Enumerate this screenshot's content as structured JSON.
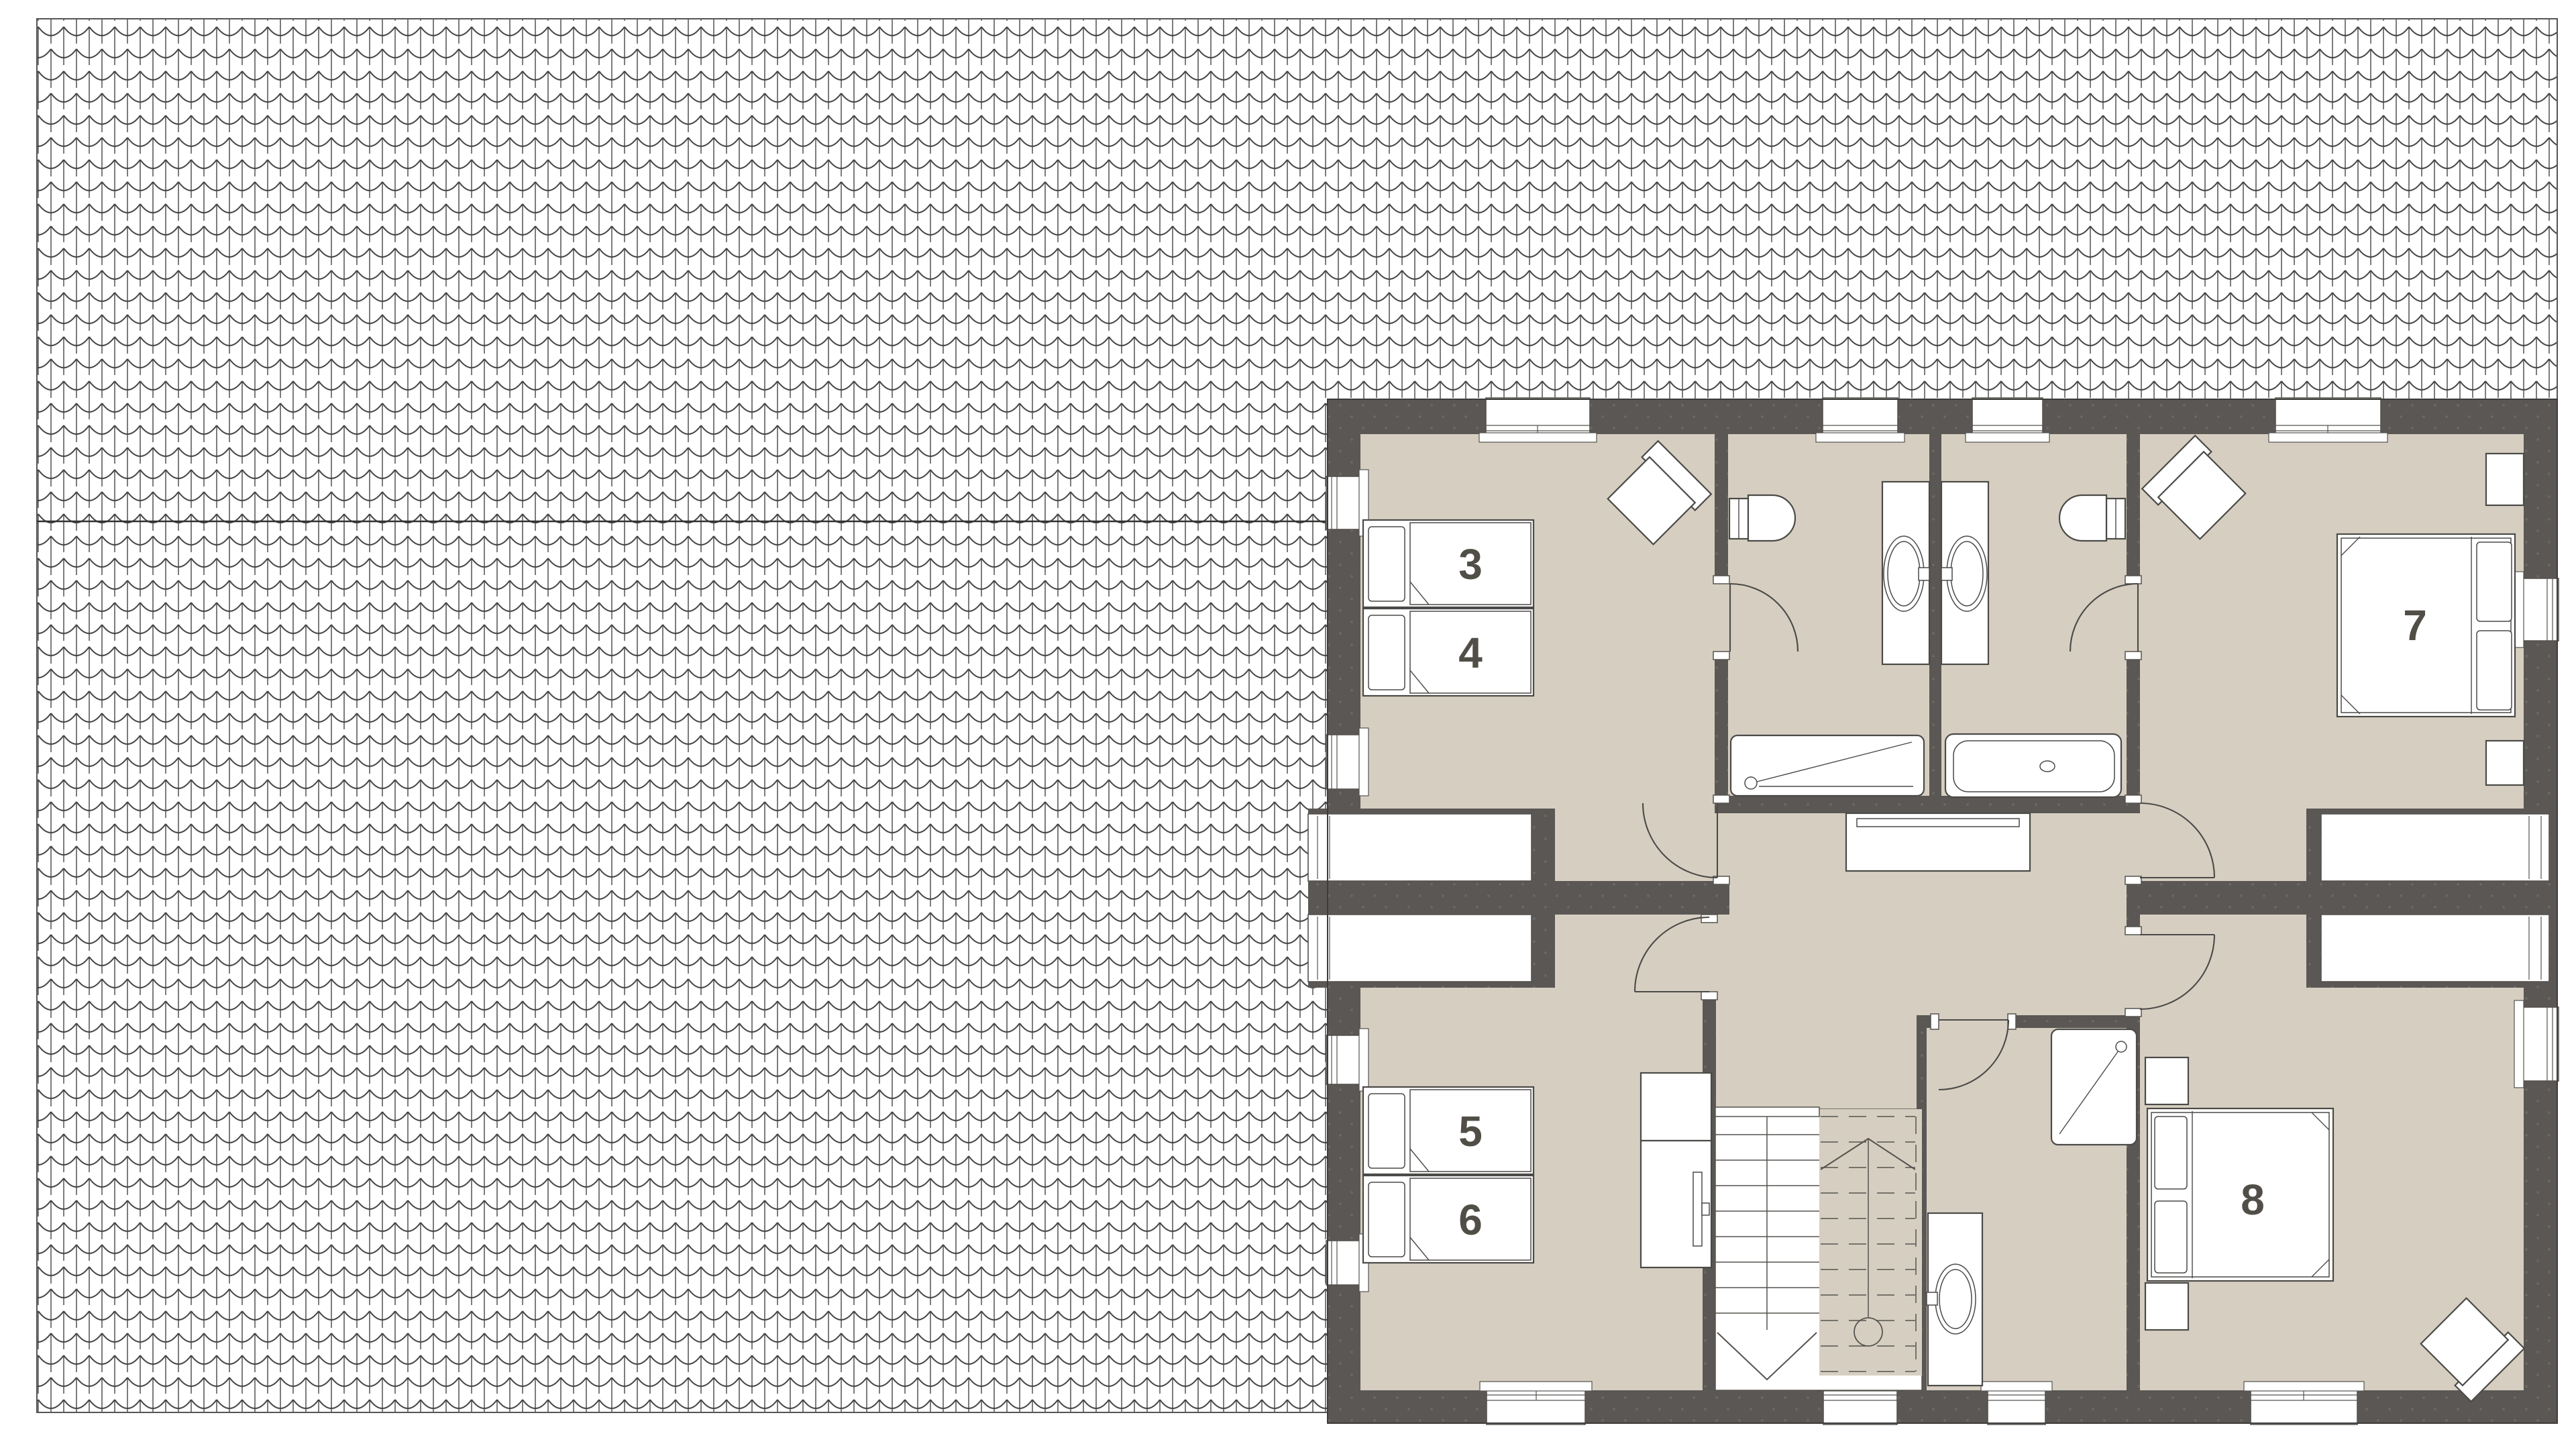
{
  "page": {
    "title": "Upper floor plan with roof",
    "type": "architectural-floor-plan"
  },
  "theme": {
    "floor": "#d6cfc1",
    "wall": "#5a5754",
    "wallDot": "#73716c",
    "line": "#55534f",
    "furnitureLine": "#4b4a48",
    "roofLine": "#323231",
    "numberColor": "#514e48",
    "background": "#ffffff"
  },
  "labels": {
    "bed3": "3",
    "bed4": "4",
    "bed5": "5",
    "bed6": "6",
    "room7": "7",
    "room8": "8"
  },
  "rooms": [
    {
      "id": "bedroom-3-4",
      "type": "bedroom",
      "bed_labels": [
        "3",
        "4"
      ],
      "furniture": [
        "single-bed",
        "single-bed",
        "armchair"
      ]
    },
    {
      "id": "bathroom-left",
      "type": "bathroom",
      "furniture": [
        "toilet",
        "sink-vanity",
        "shower"
      ]
    },
    {
      "id": "bathroom-right",
      "type": "bathroom",
      "furniture": [
        "toilet",
        "sink-vanity",
        "bathtub"
      ]
    },
    {
      "id": "bedroom-7",
      "type": "bedroom",
      "bed_labels": [
        "7"
      ],
      "furniture": [
        "double-bed",
        "nightstand",
        "nightstand",
        "armchair"
      ]
    },
    {
      "id": "bedroom-5-6",
      "type": "bedroom",
      "bed_labels": [
        "5",
        "6"
      ],
      "furniture": [
        "single-bed",
        "single-bed",
        "desk",
        "tv"
      ]
    },
    {
      "id": "hall-landing",
      "type": "hall",
      "furniture": [
        "staircase-up",
        "staircase-down",
        "console"
      ]
    },
    {
      "id": "shower-room",
      "type": "bathroom",
      "furniture": [
        "shower",
        "sink-vanity"
      ]
    },
    {
      "id": "bedroom-8",
      "type": "bedroom",
      "bed_labels": [
        "8"
      ],
      "furniture": [
        "double-bed",
        "nightstand",
        "nightstand",
        "armchair"
      ]
    }
  ]
}
